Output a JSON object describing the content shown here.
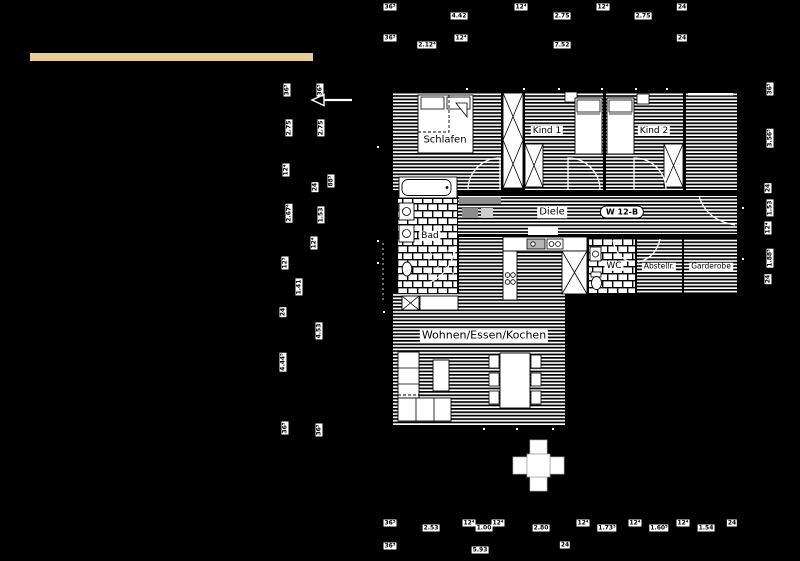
{
  "colors": {
    "background": "#000000",
    "accent_bar": "#e6cc96",
    "plan_line": "#ffffff"
  },
  "plan": {
    "unit_badge": "W 12-B",
    "room_labels": [
      {
        "name": "schlafen",
        "text": "Schlafen",
        "x": 445,
        "y": 140,
        "size": 10
      },
      {
        "name": "kind-1",
        "text": "Kind 1",
        "x": 547,
        "y": 131,
        "size": 9
      },
      {
        "name": "kind-2",
        "text": "Kind 2",
        "x": 654,
        "y": 131,
        "size": 9
      },
      {
        "name": "diele",
        "text": "Diele",
        "x": 552,
        "y": 212,
        "size": 10
      },
      {
        "name": "bad",
        "text": "Bad",
        "x": 430,
        "y": 236,
        "size": 9
      },
      {
        "name": "wc",
        "text": "WC",
        "x": 614,
        "y": 266,
        "size": 9
      },
      {
        "name": "abstellraum",
        "text": "Abstellr.",
        "x": 659,
        "y": 267,
        "size": 7.5
      },
      {
        "name": "garderobe",
        "text": "Garderobe",
        "x": 711,
        "y": 267,
        "size": 7.5
      },
      {
        "name": "wohnen-essen-kochen",
        "text": "Wohnen/Essen/Kochen",
        "x": 484,
        "y": 336,
        "size": 11
      }
    ]
  },
  "dimensions": [
    {
      "text": "36⁵",
      "x": 390,
      "y": 7,
      "rot": 0
    },
    {
      "text": "4.42",
      "x": 459,
      "y": 16,
      "rot": 0
    },
    {
      "text": "12⁴",
      "x": 521,
      "y": 7,
      "rot": 0
    },
    {
      "text": "2.75",
      "x": 562,
      "y": 16,
      "rot": 0
    },
    {
      "text": "12⁴",
      "x": 603,
      "y": 7,
      "rot": 0
    },
    {
      "text": "2.75",
      "x": 643,
      "y": 16,
      "rot": 0
    },
    {
      "text": "24",
      "x": 682,
      "y": 7,
      "rot": 0
    },
    {
      "text": "36⁵",
      "x": 390,
      "y": 38,
      "rot": 0
    },
    {
      "text": "2.12⁴",
      "x": 427,
      "y": 45,
      "rot": 0
    },
    {
      "text": "12⁴",
      "x": 461,
      "y": 38,
      "rot": 0
    },
    {
      "text": "7.52",
      "x": 562,
      "y": 45,
      "rot": 0
    },
    {
      "text": "24",
      "x": 682,
      "y": 38,
      "rot": 0
    },
    {
      "text": "36⁵",
      "x": 287,
      "y": 90,
      "rot": 1
    },
    {
      "text": "36⁵",
      "x": 320,
      "y": 90,
      "rot": 1
    },
    {
      "text": "2.75",
      "x": 289,
      "y": 128,
      "rot": 1
    },
    {
      "text": "2.75",
      "x": 321,
      "y": 128,
      "rot": 1
    },
    {
      "text": "12⁴",
      "x": 286,
      "y": 170,
      "rot": 1
    },
    {
      "text": "88⁵",
      "x": 331,
      "y": 181,
      "rot": 1
    },
    {
      "text": "24",
      "x": 315,
      "y": 187,
      "rot": 1
    },
    {
      "text": "2.67⁴",
      "x": 289,
      "y": 213,
      "rot": 1
    },
    {
      "text": "1.53",
      "x": 321,
      "y": 215,
      "rot": 1
    },
    {
      "text": "12⁴",
      "x": 314,
      "y": 243,
      "rot": 1
    },
    {
      "text": "12⁵",
      "x": 285,
      "y": 263,
      "rot": 1
    },
    {
      "text": "1.41",
      "x": 299,
      "y": 287,
      "rot": 1
    },
    {
      "text": "24",
      "x": 283,
      "y": 312,
      "rot": 1
    },
    {
      "text": "4.53",
      "x": 319,
      "y": 331,
      "rot": 1
    },
    {
      "text": "4.44⁵",
      "x": 283,
      "y": 362,
      "rot": 1
    },
    {
      "text": "36⁵",
      "x": 285,
      "y": 428,
      "rot": 1
    },
    {
      "text": "36⁵",
      "x": 319,
      "y": 430,
      "rot": 1
    },
    {
      "text": "36⁵",
      "x": 770,
      "y": 89,
      "rot": 1
    },
    {
      "text": "3.56⁵",
      "x": 770,
      "y": 138,
      "rot": 1
    },
    {
      "text": "24",
      "x": 768,
      "y": 188,
      "rot": 1
    },
    {
      "text": "1.53",
      "x": 770,
      "y": 208,
      "rot": 1
    },
    {
      "text": "12⁴",
      "x": 768,
      "y": 228,
      "rot": 1
    },
    {
      "text": "1.88⁵",
      "x": 770,
      "y": 258,
      "rot": 1
    },
    {
      "text": "24",
      "x": 768,
      "y": 279,
      "rot": 1
    },
    {
      "text": "36⁵",
      "x": 390,
      "y": 523,
      "rot": 0
    },
    {
      "text": "2.53",
      "x": 431,
      "y": 528,
      "rot": 0
    },
    {
      "text": "12⁴",
      "x": 469,
      "y": 523,
      "rot": 0
    },
    {
      "text": "1.00",
      "x": 484,
      "y": 528,
      "rot": 0
    },
    {
      "text": "12⁴",
      "x": 498,
      "y": 523,
      "rot": 0
    },
    {
      "text": "2.80",
      "x": 541,
      "y": 528,
      "rot": 0
    },
    {
      "text": "12⁴",
      "x": 583,
      "y": 523,
      "rot": 0
    },
    {
      "text": "1.73⁵",
      "x": 607,
      "y": 528,
      "rot": 0
    },
    {
      "text": "12⁴",
      "x": 635,
      "y": 523,
      "rot": 0
    },
    {
      "text": "1.60⁵",
      "x": 659,
      "y": 528,
      "rot": 0
    },
    {
      "text": "12⁴",
      "x": 683,
      "y": 523,
      "rot": 0
    },
    {
      "text": "1.54",
      "x": 706,
      "y": 528,
      "rot": 0
    },
    {
      "text": "24",
      "x": 732,
      "y": 523,
      "rot": 0
    },
    {
      "text": "36⁵",
      "x": 390,
      "y": 546,
      "rot": 0
    },
    {
      "text": "5.93",
      "x": 480,
      "y": 550,
      "rot": 0
    },
    {
      "text": "24",
      "x": 565,
      "y": 545,
      "rot": 0
    }
  ]
}
